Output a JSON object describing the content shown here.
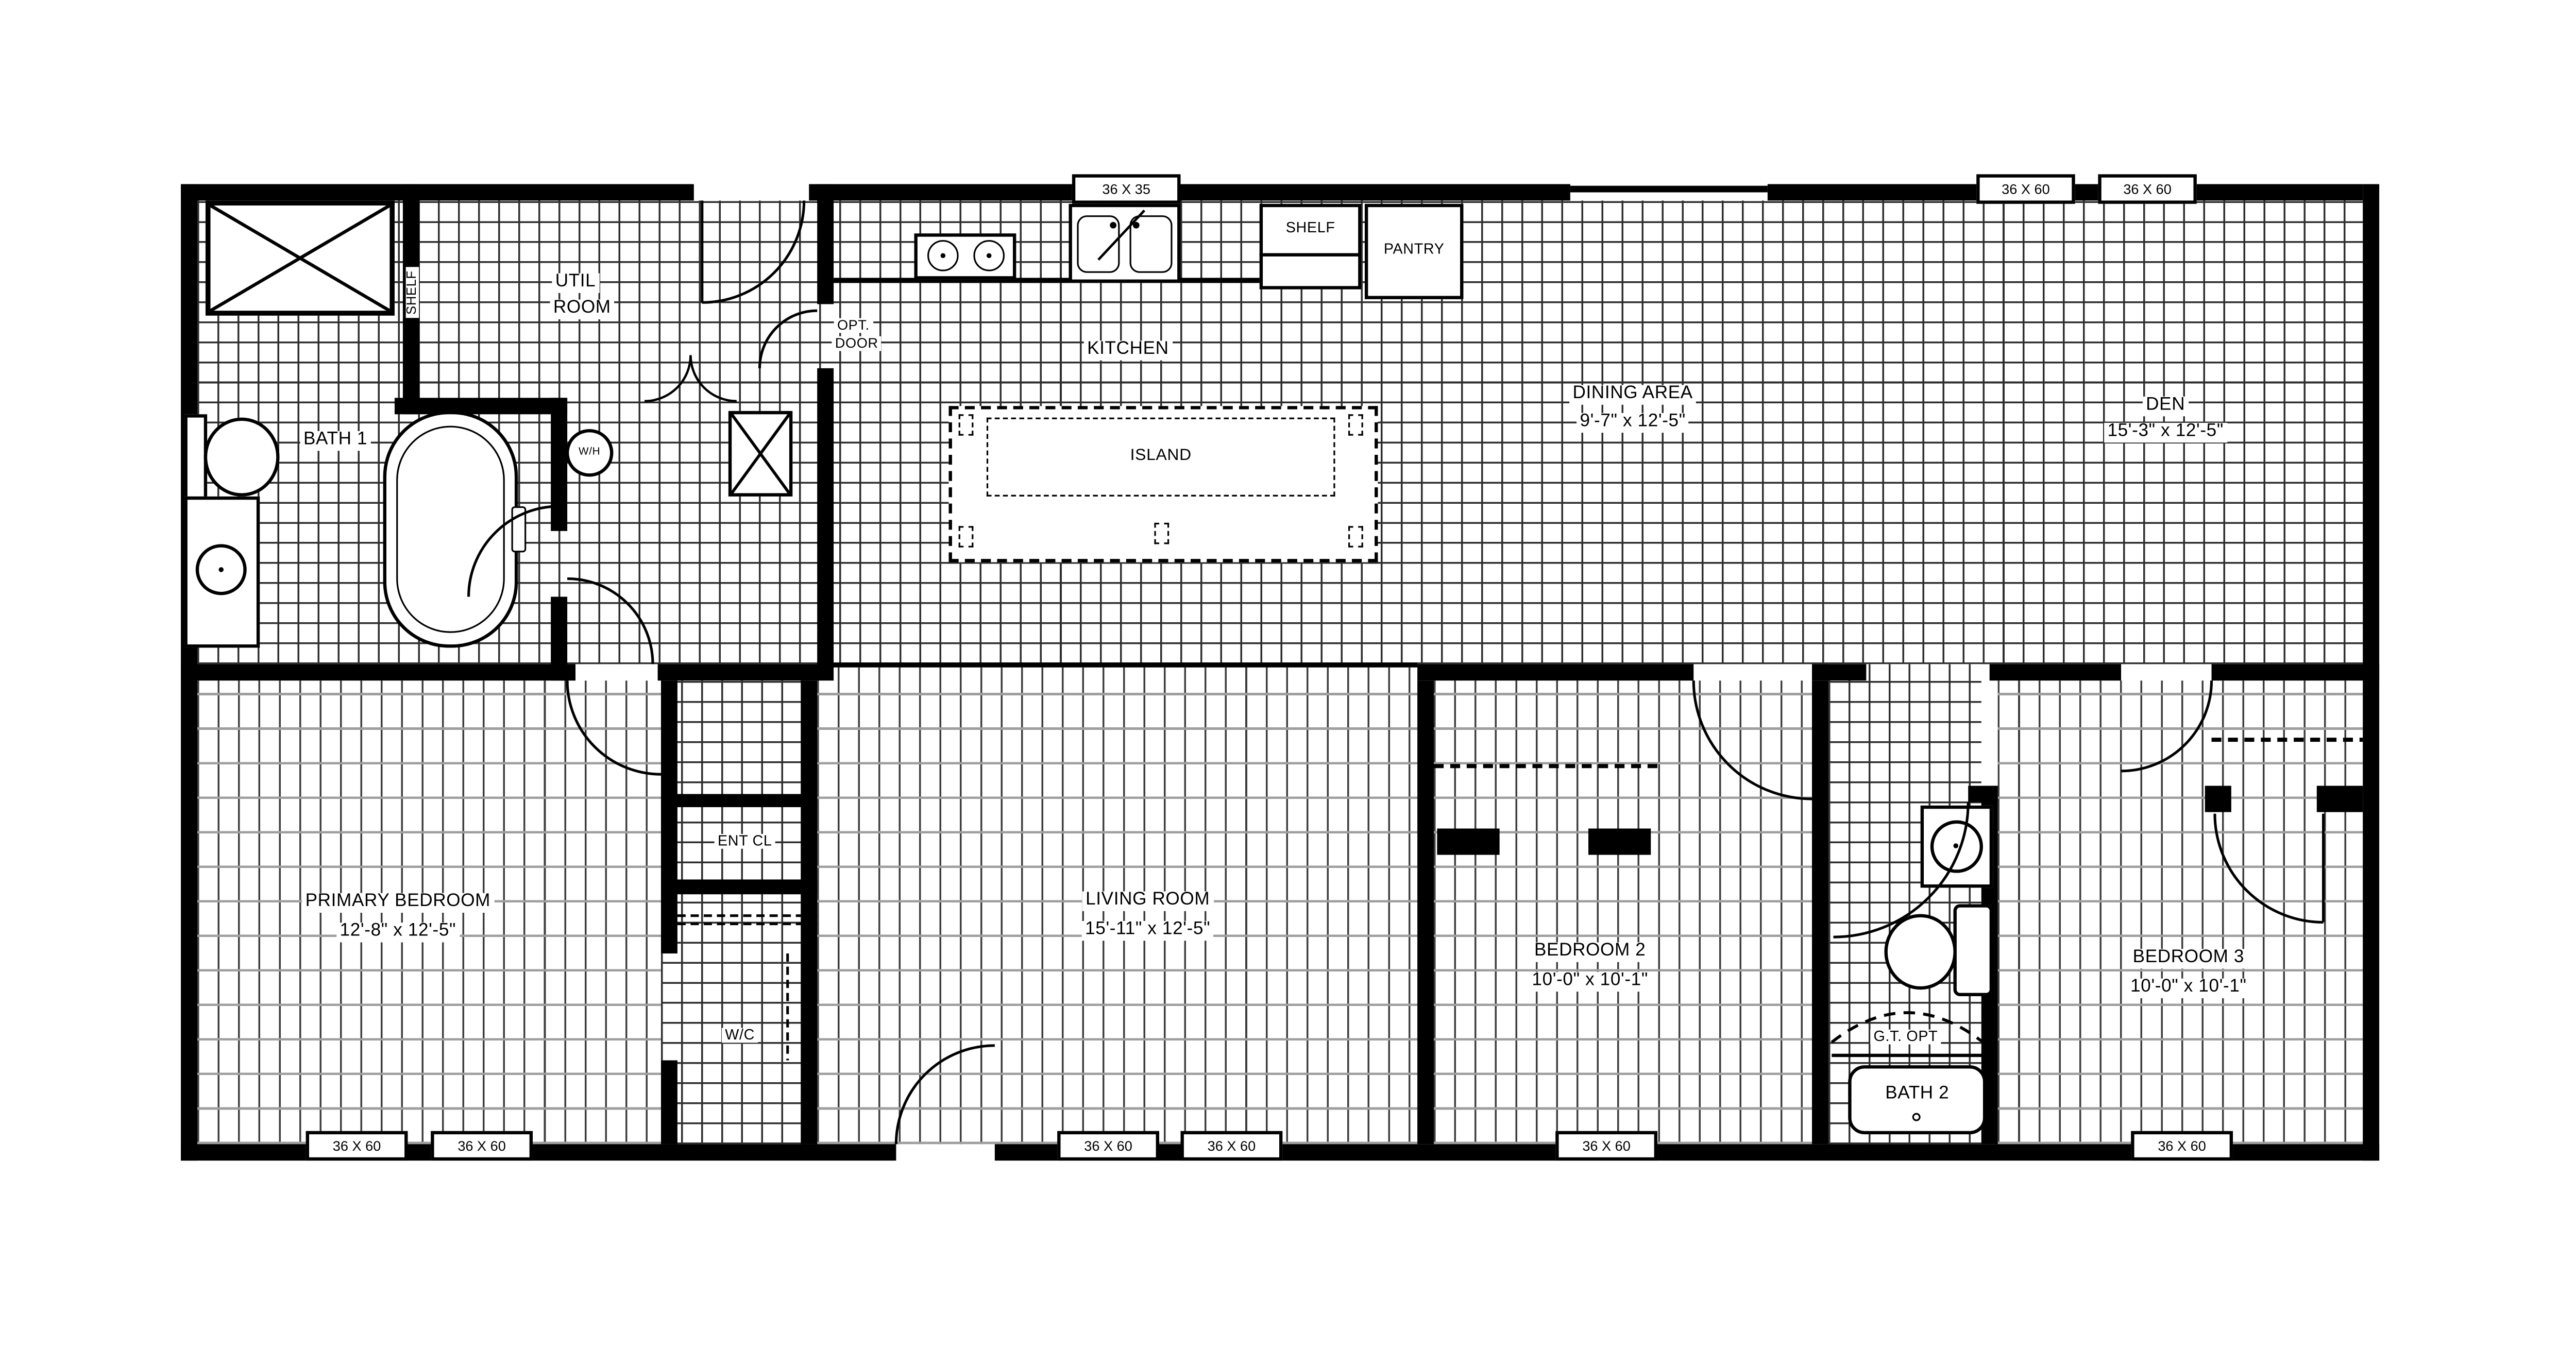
{
  "drawing_type": "manufactured home floor plan",
  "colors": {
    "walls": "#000000",
    "tile_grid_line": "#2e2e2e",
    "plank_vertical_line": "#3d3d3d",
    "plank_horizontal_line": "#9e9e9e",
    "background": "#ffffff"
  },
  "rooms": {
    "util": {
      "line1": "UTIL",
      "line2": "ROOM"
    },
    "shelf_vertical": {
      "name": "SHELF"
    },
    "bath1": {
      "name": "BATH 1"
    },
    "wh": {
      "name": "W/H"
    },
    "opt_door": {
      "line1": "OPT.",
      "line2": "DOOR"
    },
    "kitchen": {
      "name": "KITCHEN"
    },
    "island": {
      "name": "ISLAND"
    },
    "shelf_kitchen": {
      "name": "SHELF"
    },
    "pantry": {
      "name": "PANTRY"
    },
    "dining": {
      "name": "DINING AREA",
      "dims": "9'-7\" x 12'-5\""
    },
    "den": {
      "name": "DEN",
      "dims": "15'-3\" x 12'-5\""
    },
    "primary": {
      "name": "PRIMARY BEDROOM",
      "dims": "12'-8\" x 12'-5\""
    },
    "living": {
      "name": "LIVING ROOM",
      "dims": "15'-11\" x 12'-5\""
    },
    "bed2": {
      "name": "BEDROOM 2",
      "dims": "10'-0\" x 10'-1\""
    },
    "bed3": {
      "name": "BEDROOM 3",
      "dims": "10'-0\" x 10'-1\""
    },
    "bath2": {
      "name": "BATH 2"
    },
    "gt_opt": {
      "name": "G.T. OPT"
    },
    "ent_cl": {
      "name": "ENT CL"
    },
    "wc": {
      "name": "W/C"
    }
  },
  "windows": {
    "top": [
      {
        "label": "36 X 35"
      },
      {
        "label": "36 X 60"
      },
      {
        "label": "36 X 60"
      }
    ],
    "bottom": [
      {
        "label": "36 X 60"
      },
      {
        "label": "36 X 60"
      },
      {
        "label": "36 X 60"
      },
      {
        "label": "36 X 60"
      },
      {
        "label": "36 X 60"
      },
      {
        "label": "36 X 60"
      }
    ]
  }
}
